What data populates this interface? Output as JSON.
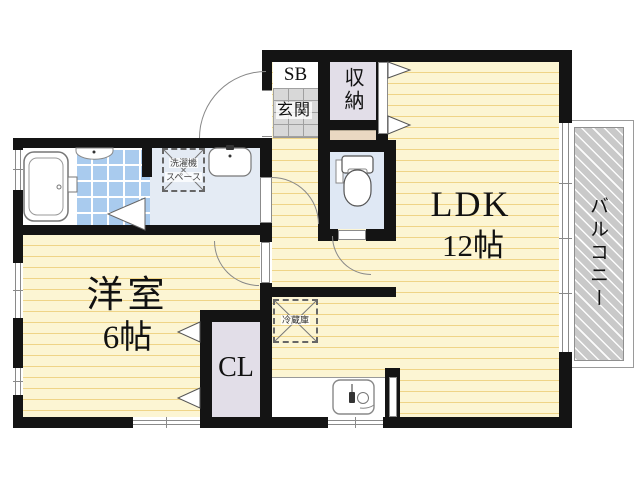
{
  "plan_title": "apartment-floor-plan",
  "rooms": {
    "ldk": {
      "name": "LDK",
      "size": "12帖"
    },
    "western": {
      "name": "洋室",
      "size": "6帖"
    },
    "closet": {
      "label": "CL"
    },
    "storage": {
      "label": "収納"
    },
    "shoebox": {
      "label": "SB"
    },
    "entrance": {
      "label": "玄関"
    },
    "balcony": {
      "label": "バルコニー"
    }
  },
  "fixtures": {
    "washer": {
      "line1": "洗濯機",
      "line2": "スペース"
    },
    "fridge": {
      "label": "冷蔵庫"
    }
  },
  "colors": {
    "wall": "#141414",
    "wood_floor": "#FCF5D3",
    "wood_stripe": "#EFD487",
    "bath_tile": "#A9CBEE",
    "washroom_floor": "#E4EBF4",
    "toilet_floor": "#DFE8F4",
    "closet_fill": "#E2DEE8",
    "entrance_tile": "#D8D8D8",
    "balcony_hatch": "#C9C9C9",
    "shelf_tan": "#EAD8C2"
  }
}
